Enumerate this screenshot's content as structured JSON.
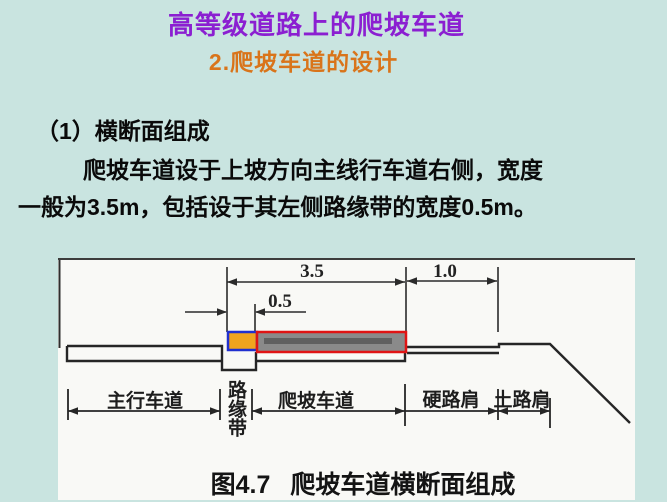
{
  "slide": {
    "title": "高等级道路上的爬坡车道",
    "subtitle": "2.爬坡车道的设计",
    "title_color": "#8B1FD1",
    "subtitle_color": "#D9741A",
    "background_color": "#C9E4E0"
  },
  "content": {
    "heading": "（1）横断面组成",
    "paragraph_lines": [
      "爬坡车道设于上坡方向主线行车道右侧，宽度",
      "一般为3.5m，包括设于其左侧路缘带的宽度0.5m。"
    ]
  },
  "figure": {
    "caption_number": "图4.7",
    "caption_text": "爬坡车道横断面组成",
    "dimensions": {
      "lane_total_width_m": "3.5",
      "hard_shoulder_width_m": "1.0",
      "curb_strip_width_m": "0.5"
    },
    "labels": {
      "main_lane": "主行车道",
      "curb_strip": "路缘带",
      "climbing_lane": "爬坡车道",
      "hard_shoulder": "硬路肩",
      "earth_shoulder": "土路肩"
    },
    "colors": {
      "curb_strip_fill": "#F0A41E",
      "curb_strip_border": "#2030CF",
      "climbing_lane_fill": "#8A8A8A",
      "climbing_lane_border": "#E01414"
    }
  }
}
